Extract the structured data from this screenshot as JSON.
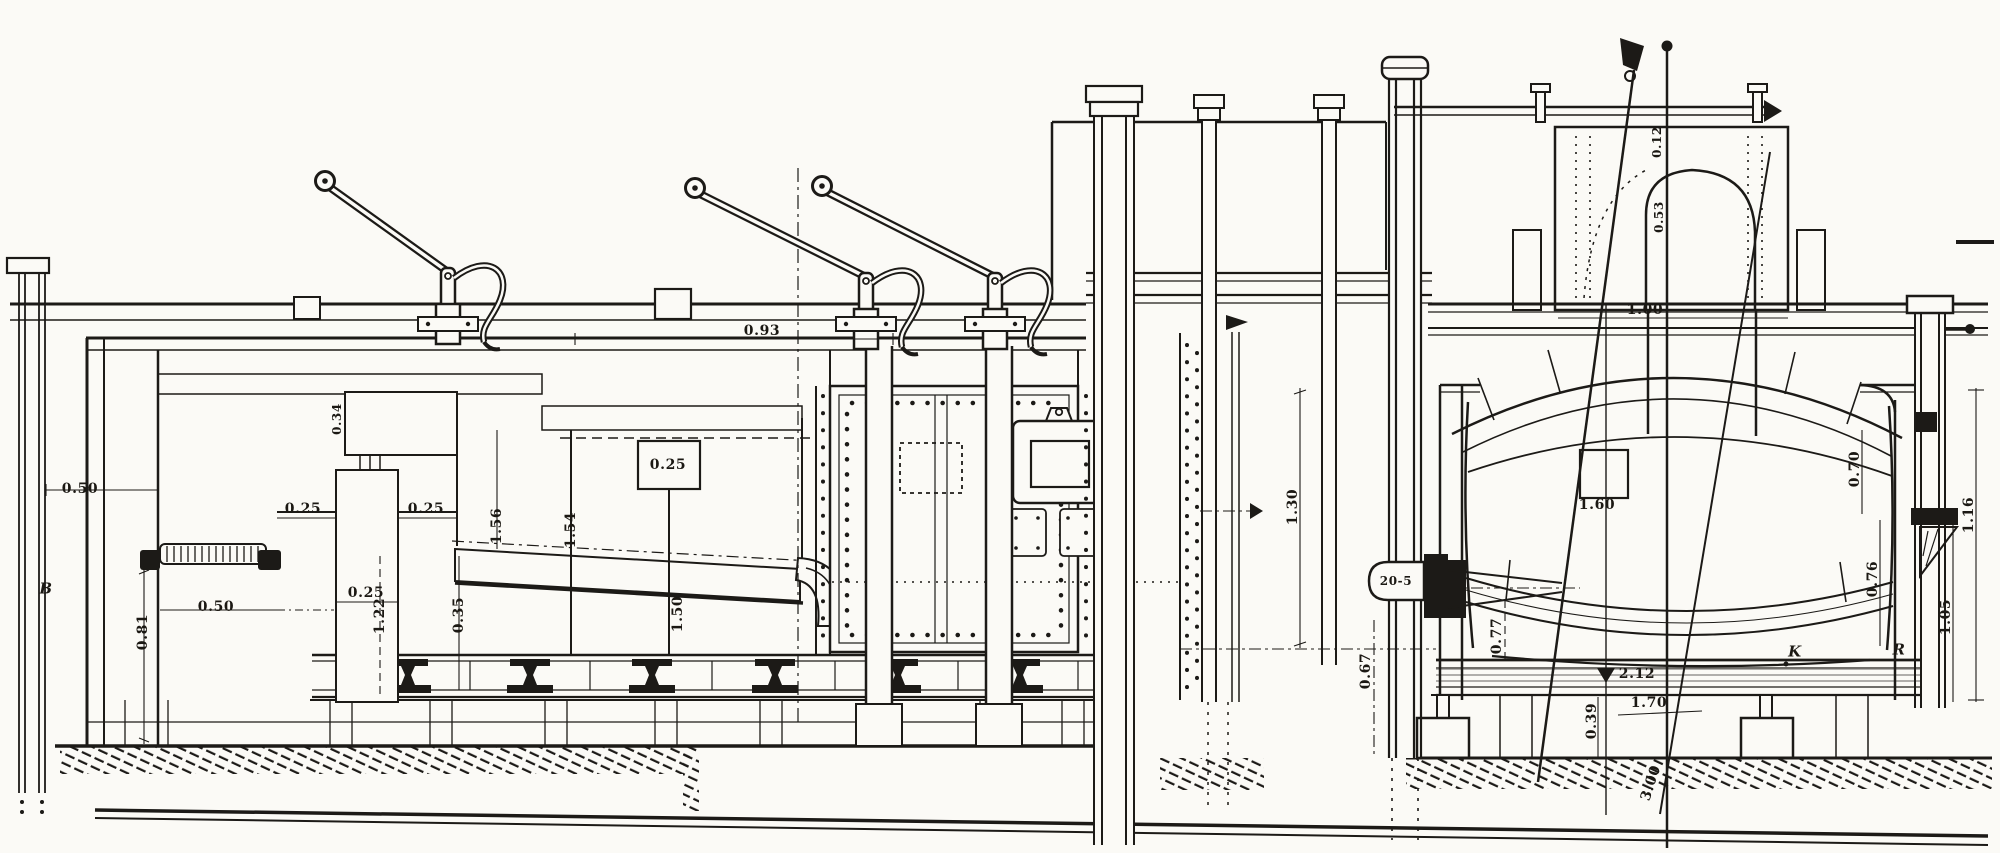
{
  "palette": {
    "ink": "#1c1a17",
    "paper": "#fbfaf6"
  },
  "figure": {
    "kind": "sectional engraving of industrial furnace plant"
  },
  "labels": [
    {
      "id": "dim-left-wall",
      "text": "0.50"
    },
    {
      "id": "letter-b",
      "text": "B"
    },
    {
      "id": "dim-hearth-width",
      "text": "0.50"
    },
    {
      "id": "dim-pit-depth",
      "text": "0.81"
    },
    {
      "id": "dim-flue-left",
      "text": "0.25"
    },
    {
      "id": "dim-flue-right",
      "text": "0.25"
    },
    {
      "id": "dim-wall-thick",
      "text": "0.34"
    },
    {
      "id": "dim-pillar-width",
      "text": "0.25"
    },
    {
      "id": "dim-pillar-height",
      "text": "1.22"
    },
    {
      "id": "dim-gap-height",
      "text": "0.35"
    },
    {
      "id": "dim-chamber-h-left",
      "text": "1.56"
    },
    {
      "id": "dim-chamber-h-mid",
      "text": "1.54"
    },
    {
      "id": "dim-damper",
      "text": "0.25"
    },
    {
      "id": "dim-shaft-height",
      "text": "1.50"
    },
    {
      "id": "dim-top-offset",
      "text": "0.93"
    },
    {
      "id": "dim-column-height",
      "text": "1.30"
    },
    {
      "id": "dim-dome-lip",
      "text": "0.12"
    },
    {
      "id": "dim-dome-depth",
      "text": "0.53"
    },
    {
      "id": "dim-neck-width",
      "text": "1.00"
    },
    {
      "id": "tap-fitting",
      "text": "20-5"
    },
    {
      "id": "dim-left-clearance",
      "text": "0.67"
    },
    {
      "id": "dim-support-height",
      "text": "0.77"
    },
    {
      "id": "dim-vessel-center",
      "text": "1.60"
    },
    {
      "id": "dim-right-upper",
      "text": "0.70"
    },
    {
      "id": "dim-right-lower",
      "text": "0.76"
    },
    {
      "id": "dim-right-outer",
      "text": "1.16"
    },
    {
      "id": "dim-right-inner",
      "text": "1.05"
    },
    {
      "id": "dim-rail-length",
      "text": "2.12"
    },
    {
      "id": "dim-base-length",
      "text": "1.70"
    },
    {
      "id": "dim-block-height",
      "text": "0.39"
    },
    {
      "id": "dim-depth-total",
      "text": "3.00"
    },
    {
      "id": "letter-k",
      "text": "K"
    },
    {
      "id": "letter-r",
      "text": "R"
    }
  ]
}
